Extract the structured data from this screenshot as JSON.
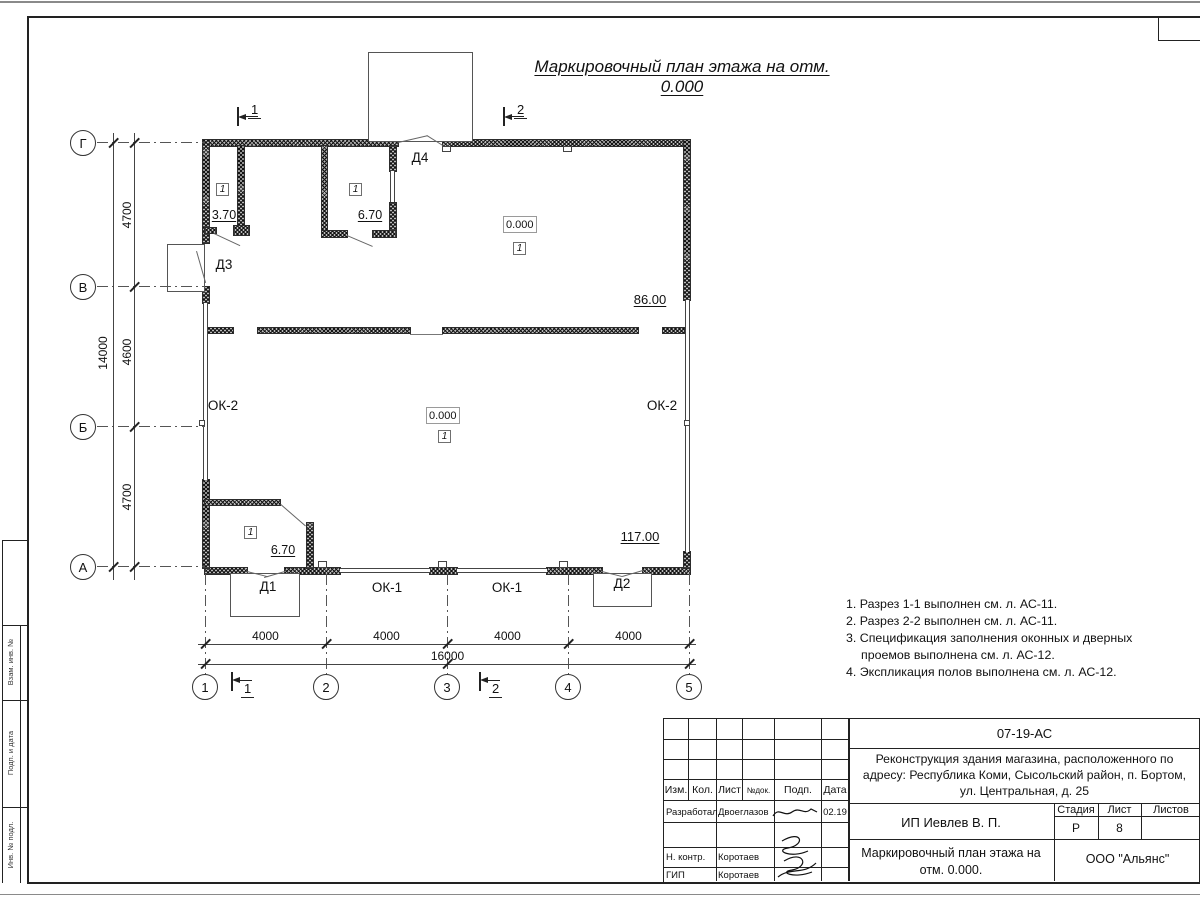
{
  "sheet": {
    "title": "Маркировочный план этажа на отм. 0.000",
    "side_labels": {
      "vzam": "Взам. инв. №",
      "podp": "Подп. и дата",
      "inv": "Инв. № подл."
    }
  },
  "plan": {
    "axis_rows": [
      "Г",
      "В",
      "Б",
      "А"
    ],
    "axis_cols": [
      "1",
      "2",
      "3",
      "4",
      "5"
    ],
    "dim_left_total": "14000",
    "dim_left_segments": [
      "4700",
      "4600",
      "4700"
    ],
    "dim_bottom_total": "16000",
    "dim_bottom_segments": [
      "4000",
      "4000",
      "4000",
      "4000"
    ],
    "sections": {
      "s1": "1",
      "s2": "2"
    },
    "rooms": {
      "top_left": {
        "floor_type": "1",
        "area": "3.70"
      },
      "top_middle": {
        "floor_type": "1",
        "area": "6.70"
      },
      "hall_upper": {
        "elevation": "0.000",
        "floor_type": "1",
        "area": "86.00"
      },
      "hall_main": {
        "elevation": "0.000",
        "floor_type": "1",
        "area": "117.00"
      },
      "bottom_left": {
        "floor_type": "1",
        "area": "6.70"
      }
    },
    "openings": {
      "d1": "Д1",
      "d2": "Д2",
      "d3": "Д3",
      "d4": "Д4",
      "ok1_a": "ОК-1",
      "ok1_b": "ОК-1",
      "ok2_left": "ОК-2",
      "ok2_right": "ОК-2"
    }
  },
  "notes": {
    "items": [
      "1. Разрез 1-1 выполнен см. л. АС-11.",
      "2. Разрез 2-2 выполнен см. л. АС-11.",
      "3. Спецификация заполнения оконных и дверных проемов выполнена см. л. АС-12.",
      "4. Экспликация полов выполнена см. л. АС-12."
    ]
  },
  "titleblock": {
    "code": "07-19-АС",
    "project": "Реконструкция здания магазина, расположенного по адресу: Республика Коми, Сысольский район, п. Бортом, ул. Центральная, д. 25",
    "columns": {
      "izm": "Изм.",
      "kol": "Кол.",
      "list": "Лист",
      "ndok": "№док.",
      "podp": "Подп.",
      "data": "Дата"
    },
    "signature_rows": [
      {
        "role": "Разработал",
        "name": "Двоеглазов",
        "date": "02.19"
      },
      {
        "role": "Н. контр.",
        "name": "Коротаев",
        "date": ""
      },
      {
        "role": "ГИП",
        "name": "Коротаев",
        "date": ""
      }
    ],
    "stage_labels": {
      "stadia": "Стадия",
      "list": "Лист",
      "listov": "Листов"
    },
    "stage_values": {
      "stadia": "Р",
      "list": "8",
      "listov": ""
    },
    "client": "ИП Иевлев В. П.",
    "doc_title": "Маркировочный план этажа на отм. 0.000.",
    "organization": "ООО \"Альянс\""
  }
}
